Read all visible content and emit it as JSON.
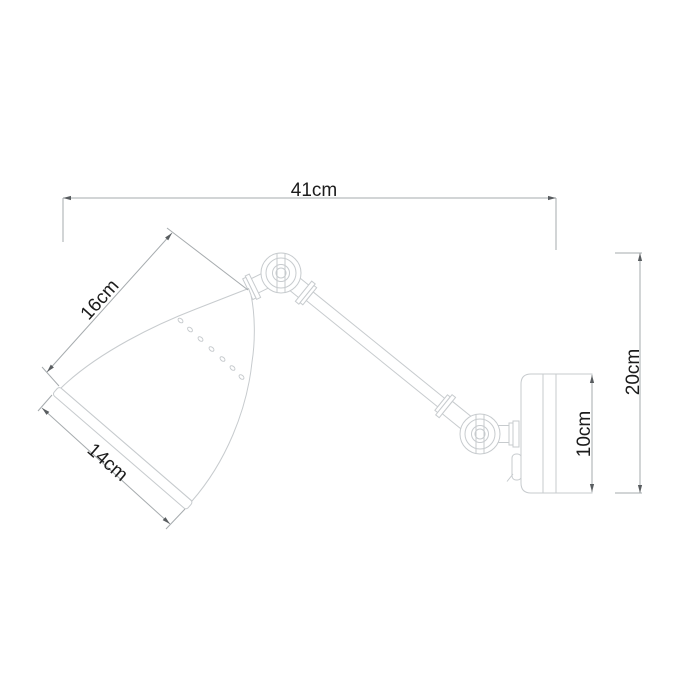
{
  "diagram": {
    "kind": "technical dimension drawing",
    "subject": "wall-mounted swing-arm lamp",
    "dimension_labels": {
      "overall_width": "41cm",
      "shade_length": "16cm",
      "shade_diameter": "14cm",
      "overall_height": "20cm",
      "wall_plate_height": "10cm"
    },
    "colors": {
      "background": "#ffffff",
      "drawing_line": "#c7cbce",
      "dimension_line": "#a6abae",
      "arrow": "#595d60",
      "label_text": "#1c1c1c"
    }
  }
}
